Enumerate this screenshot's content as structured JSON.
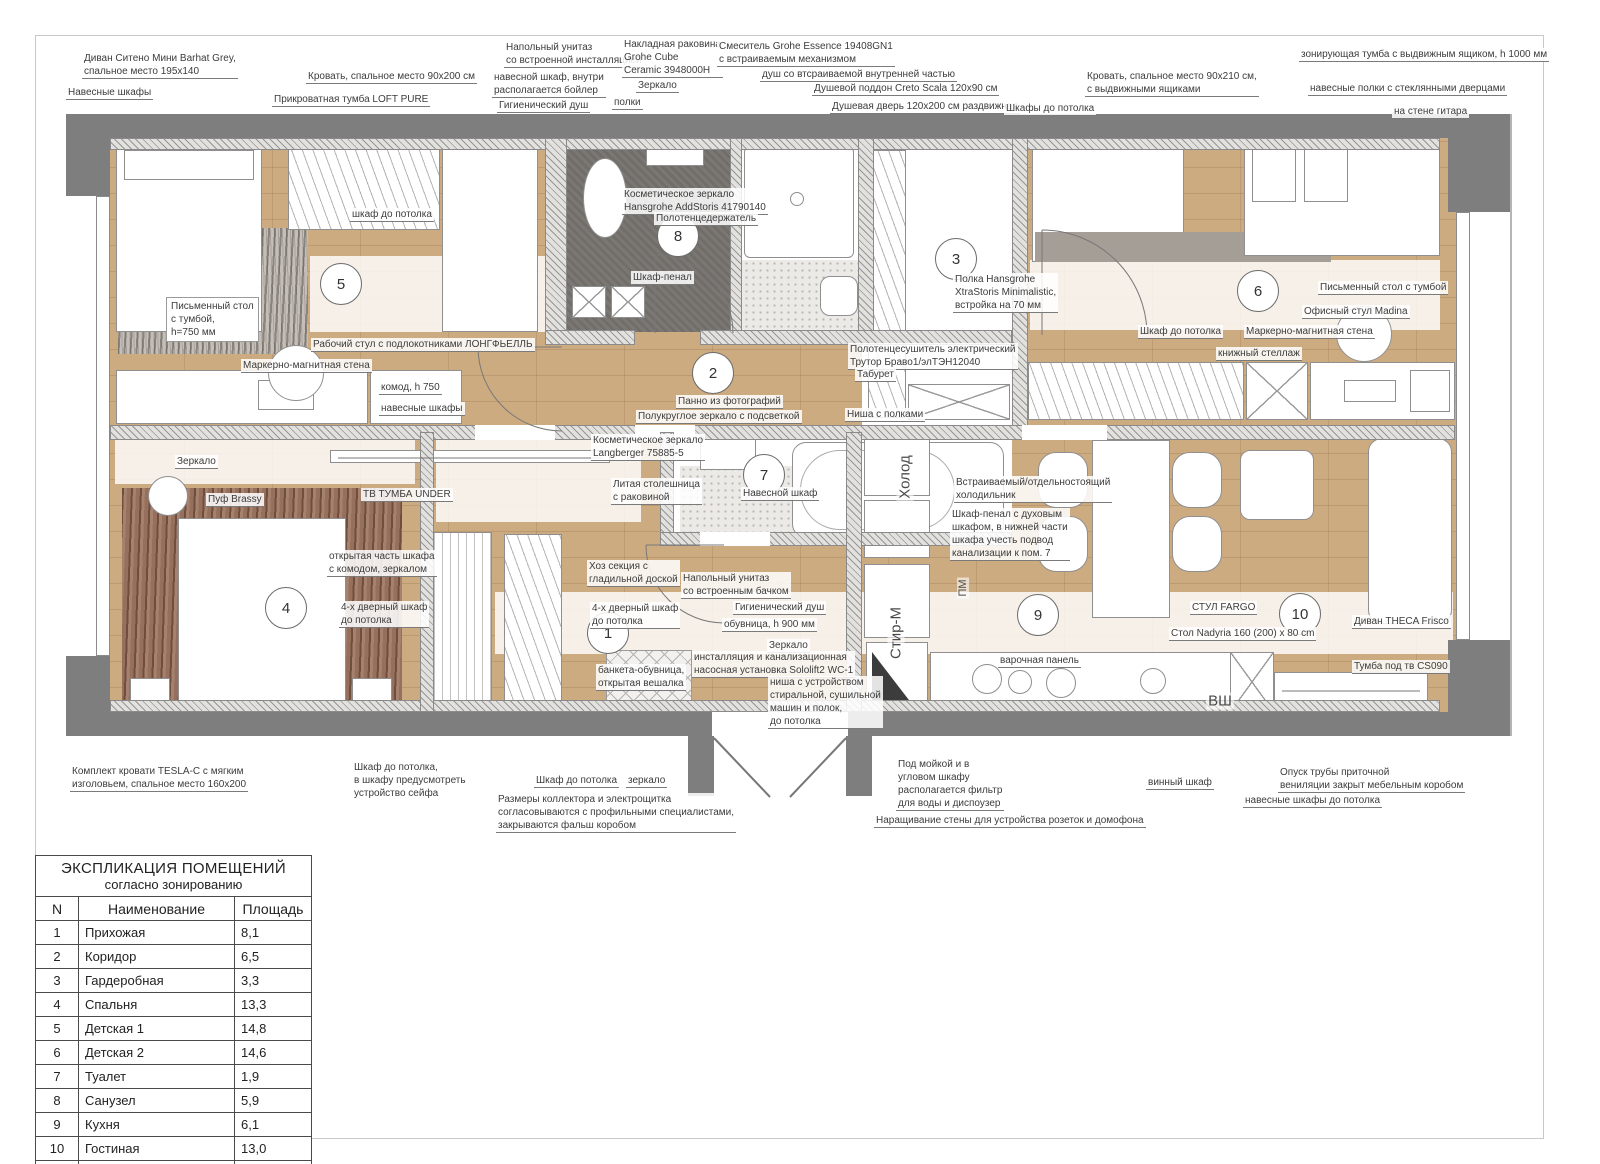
{
  "legend": {
    "title": "ЭКСПЛИКАЦИЯ ПОМЕЩЕНИЙ",
    "subtitle": "согласно зонированию",
    "columns": [
      "N",
      "Наименование",
      "Площадь"
    ],
    "rows": [
      [
        "1",
        "Прихожая",
        "8,1"
      ],
      [
        "2",
        "Коридор",
        "6,5"
      ],
      [
        "3",
        "Гардеробная",
        "3,3"
      ],
      [
        "4",
        "Спальня",
        "13,3"
      ],
      [
        "5",
        "Детская 1",
        "14,8"
      ],
      [
        "6",
        "Детская 2",
        "14,6"
      ],
      [
        "7",
        "Туалет",
        "1,9"
      ],
      [
        "8",
        "Санузел",
        "5,9"
      ],
      [
        "9",
        "Кухня",
        "6,1"
      ],
      [
        "10",
        "Гостиная",
        "13,0"
      ]
    ],
    "total": "87,5 м²"
  },
  "rooms": [
    {
      "n": "1",
      "x": 607,
      "y": 632
    },
    {
      "n": "2",
      "x": 712,
      "y": 372
    },
    {
      "n": "3",
      "x": 955,
      "y": 258
    },
    {
      "n": "4",
      "x": 285,
      "y": 607
    },
    {
      "n": "5",
      "x": 340,
      "y": 283
    },
    {
      "n": "6",
      "x": 1257,
      "y": 290
    },
    {
      "n": "7",
      "x": 763,
      "y": 474
    },
    {
      "n": "8",
      "x": 677,
      "y": 235
    },
    {
      "n": "9",
      "x": 1037,
      "y": 614
    },
    {
      "n": "10",
      "x": 1299,
      "y": 613
    }
  ],
  "vertical_labels": [
    {
      "t": "Холод",
      "x": 905,
      "y": 477,
      "s": 15,
      "hz": 0
    },
    {
      "t": "Стир-М",
      "x": 896,
      "y": 633,
      "s": 15,
      "hz": 0
    },
    {
      "t": "ПМ",
      "x": 963,
      "y": 588,
      "s": 11,
      "hz": 0
    },
    {
      "t": "ВШ",
      "x": 1220,
      "y": 701,
      "s": 15,
      "hz": 1
    }
  ],
  "labels": [
    {
      "t": "Диван Ситено Мини Barhat Grey,\nспальное место 195x140",
      "x": 82,
      "y": 52,
      "u": 1
    },
    {
      "t": "Навесные шкафы",
      "x": 66,
      "y": 86,
      "u": 1
    },
    {
      "t": "Кровать, спальное место 90x200 см",
      "x": 306,
      "y": 70,
      "u": 1
    },
    {
      "t": "Прикроватная тумба LOFT PURE",
      "x": 272,
      "y": 93,
      "u": 1
    },
    {
      "t": "Напольный унитаз\nсо встроенной инсталляцией",
      "x": 504,
      "y": 41,
      "u": 1
    },
    {
      "t": "навесной шкаф, внутри\nрасполагается бойлер",
      "x": 492,
      "y": 71,
      "u": 1
    },
    {
      "t": "Гигиенический душ",
      "x": 497,
      "y": 99,
      "u": 1
    },
    {
      "t": "Накладная раковина\nGrohe Cube\nCeramic 3948000H",
      "x": 622,
      "y": 38,
      "u": 1
    },
    {
      "t": "Зеркало",
      "x": 636,
      "y": 79,
      "u": 1
    },
    {
      "t": "полки",
      "x": 612,
      "y": 96,
      "u": 1
    },
    {
      "t": "Смеситель Grohe Essence 19408GN1\nс встраиваемым механизмом",
      "x": 717,
      "y": 40,
      "u": 1
    },
    {
      "t": "душ со втсраиваемой внутренней частью",
      "x": 760,
      "y": 68,
      "u": 1
    },
    {
      "t": "Душевой поддон Creto Scala 120x90 см",
      "x": 812,
      "y": 82,
      "u": 1
    },
    {
      "t": "Душевая дверь 120x200 см раздвижная",
      "x": 830,
      "y": 100,
      "u": 1
    },
    {
      "t": "Шкафы до потолка",
      "x": 1004,
      "y": 102,
      "u": 1
    },
    {
      "t": "Кровать, спальное место 90x210 см,\nс выдвижными ящиками",
      "x": 1085,
      "y": 70,
      "u": 1
    },
    {
      "t": "зонирующая тумба с выдвижным ящиком, h 1000 мм",
      "x": 1299,
      "y": 48,
      "u": 1
    },
    {
      "t": "навесные полки с стеклянными дверцами",
      "x": 1308,
      "y": 82,
      "u": 1
    },
    {
      "t": "на стене гитара",
      "x": 1392,
      "y": 105,
      "u": 1
    },
    {
      "t": "шкаф до потолка",
      "x": 350,
      "y": 208,
      "u": 1
    },
    {
      "t": "Письменный стол\nс тумбой,\nh=750 мм",
      "x": 166,
      "y": 297,
      "box": 1
    },
    {
      "t": "Рабочий стул с подлокотниками ЛОНГФЬЕЛЛЬ",
      "x": 311,
      "y": 338,
      "u": 1
    },
    {
      "t": "Маркерно-магнитная стена",
      "x": 241,
      "y": 359,
      "u": 1
    },
    {
      "t": "комод, h 750",
      "x": 379,
      "y": 381,
      "u": 1
    },
    {
      "t": "навесные шкафы",
      "x": 379,
      "y": 402,
      "u": 1
    },
    {
      "t": "Косметическое зеркало\nHansgrohe AddStoris 41790140",
      "x": 622,
      "y": 188,
      "u": 1
    },
    {
      "t": "Полотенцедержатель",
      "x": 654,
      "y": 212,
      "u": 1
    },
    {
      "t": "Шкаф-пенал",
      "x": 631,
      "y": 271,
      "u": 1
    },
    {
      "t": "Полка Hansgrohe\nXtraStoris Minimalistic,\nвстройка на 70 мм",
      "x": 953,
      "y": 273,
      "u": 1
    },
    {
      "t": "Полотенцесушитель электрический\nТрутор Браво1/элТЭН12040",
      "x": 848,
      "y": 343,
      "u": 1
    },
    {
      "t": "Табурет",
      "x": 855,
      "y": 368,
      "u": 1
    },
    {
      "t": "Панно из фотографий",
      "x": 676,
      "y": 395,
      "u": 1
    },
    {
      "t": "Полукруглое зеркало с подсветкой",
      "x": 636,
      "y": 410,
      "u": 1
    },
    {
      "t": "Ниша с полками",
      "x": 845,
      "y": 408,
      "u": 1
    },
    {
      "t": "Шкаф до потолка",
      "x": 1138,
      "y": 325,
      "u": 1
    },
    {
      "t": "Маркерно-магнитная стена",
      "x": 1244,
      "y": 325,
      "u": 1
    },
    {
      "t": "книжный стеллаж",
      "x": 1216,
      "y": 347,
      "u": 1
    },
    {
      "t": "Письменный стол с тумбой",
      "x": 1318,
      "y": 281,
      "u": 1
    },
    {
      "t": "Офисный стул Madina",
      "x": 1302,
      "y": 305,
      "u": 1
    },
    {
      "t": "Зеркало",
      "x": 175,
      "y": 455,
      "u": 1
    },
    {
      "t": "Пуф Brassy",
      "x": 206,
      "y": 493,
      "u": 1
    },
    {
      "t": "ТВ ТУМБА UNDER",
      "x": 361,
      "y": 488,
      "u": 1
    },
    {
      "t": "открытая часть шкафа\nс комодом, зеркалом",
      "x": 327,
      "y": 550,
      "u": 1
    },
    {
      "t": "4-х дверный шкаф\nдо потолка",
      "x": 339,
      "y": 601,
      "u": 1
    },
    {
      "t": "Косметическое зеркало\nLangberger 75885-5",
      "x": 591,
      "y": 434,
      "u": 1
    },
    {
      "t": "Литая столешница\nс раковиной",
      "x": 611,
      "y": 478,
      "u": 1
    },
    {
      "t": "Навесной шкаф",
      "x": 741,
      "y": 487,
      "u": 1
    },
    {
      "t": "Хоз секция с\nгладильной доской",
      "x": 587,
      "y": 560,
      "u": 1
    },
    {
      "t": "Напольный унитаз\nсо встроенным бачком",
      "x": 681,
      "y": 572,
      "u": 1
    },
    {
      "t": "4-х дверный шкаф\nдо потолка",
      "x": 590,
      "y": 602,
      "u": 1
    },
    {
      "t": "Гигиенический душ",
      "x": 733,
      "y": 601,
      "u": 1
    },
    {
      "t": "обувница, h 900 мм",
      "x": 722,
      "y": 618,
      "u": 1
    },
    {
      "t": "Зеркало",
      "x": 767,
      "y": 639,
      "u": 1
    },
    {
      "t": "инсталляция и канализационная\nнасосная установка Sololift2 WC-1",
      "x": 692,
      "y": 651,
      "u": 1
    },
    {
      "t": "банкета-обувница,\nоткрытая вешалка",
      "x": 596,
      "y": 664,
      "u": 1
    },
    {
      "t": "ниша с устройством\nстиральной, сушильной\nмашин и полок,\nдо потолка",
      "x": 768,
      "y": 676,
      "u": 1
    },
    {
      "t": "Встраиваемый/отдельностоящий\nхолодильник",
      "x": 954,
      "y": 476,
      "u": 1
    },
    {
      "t": "Шкаф-пенал с духовым\nшкафом, в нижней части\nшкафа учесть подвод\nканализации к пом. 7",
      "x": 950,
      "y": 508,
      "u": 1
    },
    {
      "t": "СТУЛ FARGO",
      "x": 1190,
      "y": 601,
      "u": 1
    },
    {
      "t": "Стол Nadyria 160 (200) x 80 cm",
      "x": 1169,
      "y": 627,
      "u": 1
    },
    {
      "t": "Диван THECA Frisco",
      "x": 1352,
      "y": 615,
      "u": 1
    },
    {
      "t": "Тумба под тв CS090",
      "x": 1352,
      "y": 660,
      "u": 1
    },
    {
      "t": "варочная панель",
      "x": 998,
      "y": 654,
      "u": 1
    },
    {
      "t": "Комплект кровати TESLA-C с мягким\nизголовьем, спальное место 160x200",
      "x": 70,
      "y": 765,
      "u": 1
    },
    {
      "t": "Шкаф до потолка,\nв шкафу предусмотреть\nустройство сейфа",
      "x": 352,
      "y": 761
    },
    {
      "t": "Шкаф до потолка",
      "x": 534,
      "y": 774,
      "u": 1
    },
    {
      "t": "зеркало",
      "x": 626,
      "y": 774,
      "u": 1
    },
    {
      "t": "Размеры коллектора и электрощитка\nсогласовываются с профильными специалистами,\nзакрываются фальш коробом",
      "x": 496,
      "y": 793,
      "u": 1
    },
    {
      "t": "Под мойкой и в\nугловом шкафу\nрасполагается фильтр\nдля воды и диспоузер",
      "x": 896,
      "y": 758,
      "u": 1
    },
    {
      "t": "винный шкаф",
      "x": 1146,
      "y": 776,
      "u": 1
    },
    {
      "t": "Опуск трубы приточной\nвениляции закрыт мебельным коробом",
      "x": 1278,
      "y": 766,
      "u": 1
    },
    {
      "t": "навесные шкафы до потолка",
      "x": 1243,
      "y": 794,
      "u": 1
    },
    {
      "t": "Наращивание стены для устройства розеток и домофона",
      "x": 874,
      "y": 814,
      "u": 1
    }
  ]
}
